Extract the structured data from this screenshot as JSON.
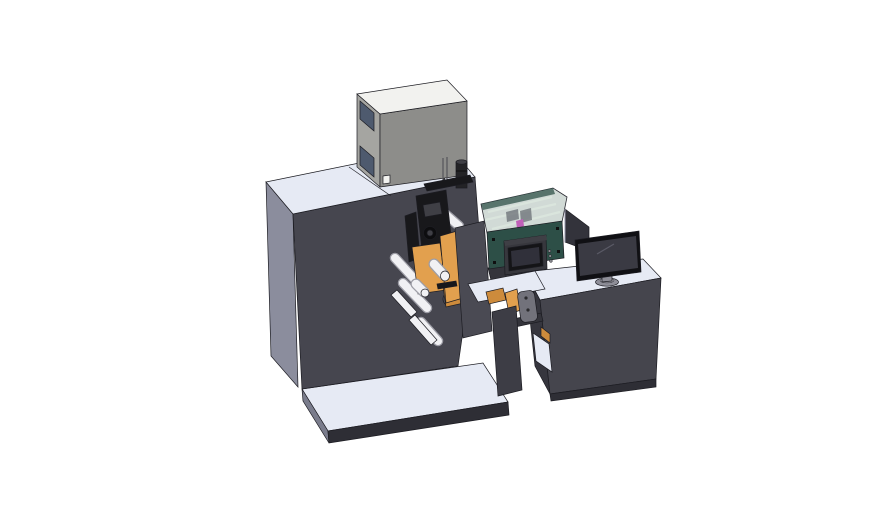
{
  "colors": {
    "background": "#ffffff",
    "surface_light": "#e6eaf4",
    "base_side": "#7a7c8c",
    "base_front": "#2e2e35",
    "machine_body_side": "#8b8d9d",
    "machine_body_front": "#46464f",
    "body_detail": "#50505a",
    "gray_box_side": "#a5a5a1",
    "gray_box_front": "#8d8d8a",
    "gray_box_top": "#f2f2ef",
    "window_glass": "#4e5a6e",
    "cylinder_black": "#232326",
    "black_part": "#18181b",
    "black_part_light": "#3f3f45",
    "black_deep": "#0d0d0f",
    "roller_white": "#f1f1f4",
    "roller_shadow": "#9d9da6",
    "web_orange": "#e2a04e",
    "web_orange_dark": "#cd8b3c",
    "plate_dark": "#4a4a53",
    "rail_dark": "#34343b",
    "enclosure_glass": "rgba(172,188,180,0.55)",
    "enclosure_wall": "#2f5148",
    "enclosure_rib": "#dce6de",
    "mech_gray": "#63676d",
    "magenta_part": "#c060b8",
    "panel_teal": "#2d4f47",
    "hmi_housing": "#37373d",
    "hmi_bezel": "#141417",
    "hmi_screen": "#30303a",
    "button_gray": "#8a8a90",
    "desk_front": "#45454d",
    "desk_side": "#36363e",
    "desk_skirt": "#2e2e35",
    "column_dark": "#3d3d45",
    "bracket_gray": "#72727b",
    "monitor_bezel": "#101014",
    "monitor_screen": "#3a3a43",
    "monitor_stand": "#8e8e98",
    "monitor_stand_light": "#b2b2bc",
    "rear_panel": "#33333b"
  }
}
